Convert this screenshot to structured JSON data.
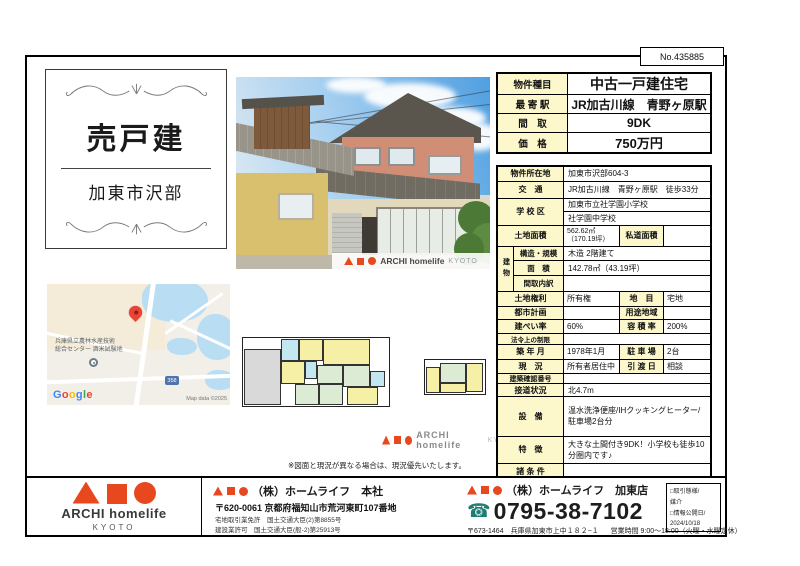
{
  "meta": {
    "doc_no": "No.435885"
  },
  "title_card": {
    "sale_type": "売戸建",
    "area": "加東市沢部"
  },
  "summary": {
    "rows": [
      {
        "label": "物件種目",
        "value": "中古一戸建住宅"
      },
      {
        "label": "最 寄 駅",
        "value": "JR加古川線　青野ヶ原駅"
      },
      {
        "label": "間　取",
        "value": "9DK"
      },
      {
        "label": "価　格",
        "value": "750万円"
      }
    ]
  },
  "details": {
    "address": {
      "label": "物件所在地",
      "value": "加東市沢部604-3"
    },
    "transport": {
      "label": "交　通",
      "value": "JR加古川線　青野ヶ原駅　徒歩33分"
    },
    "school": {
      "label": "学 校 区",
      "line1": "加東市立社学園小学校",
      "line2": "社学園中学校"
    },
    "land_area": {
      "label": "土地面積",
      "value": "562.62㎡（170.19坪）",
      "label2": "私道面積",
      "value2": ""
    },
    "building_label": "建物",
    "structure": {
      "label": "構造・規模",
      "value": "木造 2階建て"
    },
    "floor_area": {
      "label": "面　積",
      "value": "142.78㎡（43.19坪）"
    },
    "layout_detail": {
      "label": "間取内訳",
      "value": ""
    },
    "land_right": {
      "label": "土地権利",
      "value": "所有権",
      "label2": "地　目",
      "value2": "宅地"
    },
    "city_plan": {
      "label": "都市計画",
      "value": "",
      "label2": "用途地域",
      "value2": ""
    },
    "coverage": {
      "label": "建ぺい率",
      "value": "60%",
      "label2": "容 積 率",
      "value2": "200%"
    },
    "legal": {
      "label": "法令上の制限",
      "value": ""
    },
    "built": {
      "label": "築 年 月",
      "value": "1978年1月",
      "label2": "駐 車 場",
      "value2": "2台"
    },
    "current": {
      "label": "現　況",
      "value": "所有者居住中",
      "label2": "引 渡 日",
      "value2": "相談"
    },
    "confirm_no": {
      "label": "建築確認番号",
      "value": ""
    },
    "road": {
      "label": "接道状況",
      "value": "北4.7m"
    },
    "equipment": {
      "label": "設　備",
      "value": "温水洗浄便座/IHクッキングヒーター/駐車場2台分"
    },
    "feature": {
      "label": "特　徴",
      "value": "大きな土間付き9DK！小学校も徒歩10分圏内です♪"
    },
    "terms": {
      "label": "諸 条 件",
      "value": ""
    }
  },
  "photo": {
    "watermark_brand": "ARCHI homelife",
    "watermark_sub": "KYOTO"
  },
  "map": {
    "poi_line1": "兵庫県立農林水産技術",
    "poi_line2": "総合センター 酒米試験地",
    "shield": "358",
    "google_letters": [
      "G",
      "o",
      "o",
      "g",
      "l",
      "e"
    ],
    "copyright": "Map data ©2025"
  },
  "floorplan": {
    "note": "※図面と現況が異なる場合は、現況優先いたします。",
    "watermark_brand": "ARCHI homelife",
    "watermark_sub": "KYOTO"
  },
  "footer": {
    "logo": {
      "brand": "ARCHI homelife",
      "sub": "KYOTO"
    },
    "head_office": {
      "name": "（株）ホームライフ　本社",
      "postal_address": "〒620-0061 京都府福知山市荒河東町107番地",
      "license1": "宅地取引業免許　国土交通大臣(2)第8855号",
      "license2": "建設業許可　国土交通大臣(般-2)第25913号"
    },
    "branch": {
      "name": "（株）ホームライフ　加東店",
      "phone": "0795-38-7102",
      "address": "〒673-1464　兵庫県加東市上中１８２−１",
      "hours": "営業時間 9:00～18:00（火曜・水曜定休）"
    },
    "deal_box": {
      "line1": "□取引態様/",
      "line2": "媒介",
      "line3": "□情報公開日/",
      "line4": "2024/10/18"
    }
  },
  "colors": {
    "accent_red": "#e8481e",
    "label_yellow": "#fcf8cc",
    "phone_teal": "#1b7f74",
    "map_pin": "#ea4335",
    "google": [
      "#4285F4",
      "#EA4335",
      "#FBBC05",
      "#4285F4",
      "#34A853",
      "#EA4335"
    ]
  }
}
